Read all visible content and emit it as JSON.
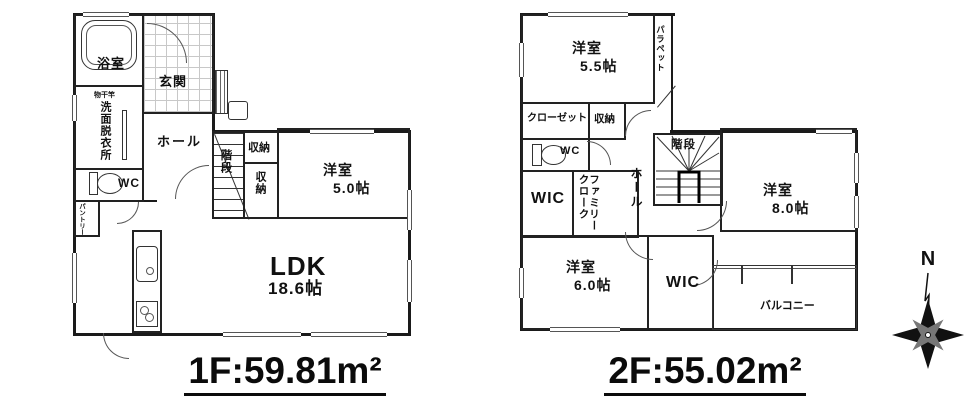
{
  "floor1": {
    "area_label": "1F:59.81m²",
    "rooms": {
      "bath": "浴室",
      "entrance": "玄関",
      "laundry_pole": "物干竿",
      "washroom": "洗面脱衣所",
      "hall": "ホール",
      "wc": "WC",
      "pantry": "パントリー",
      "stairs": "階段",
      "storage_a": "収納",
      "storage_b": "収納",
      "bedroom5_name": "洋室",
      "bedroom5_size": "5.0帖",
      "ldk_name": "LDK",
      "ldk_size": "18.6帖"
    }
  },
  "floor2": {
    "area_label": "2F:55.02m²",
    "rooms": {
      "bedroom55_name": "洋室",
      "bedroom55_size": "5.5帖",
      "parapet": "パラペット",
      "closet": "クローゼット",
      "storage": "収納",
      "wc": "WC",
      "wic_upper": "WIC",
      "family_cloak": "ファミリークローク",
      "hall": "ホール",
      "stairs": "階段",
      "bedroom8_name": "洋室",
      "bedroom8_size": "8.0帖",
      "bedroom6_name": "洋室",
      "bedroom6_size": "6.0帖",
      "wic_lower": "WIC",
      "balcony": "バルコニー"
    }
  },
  "compass": {
    "north_label": "N"
  },
  "colors": {
    "wall": "#1a1a1a",
    "text": "#111111",
    "grid_line": "#c8c8c8"
  }
}
